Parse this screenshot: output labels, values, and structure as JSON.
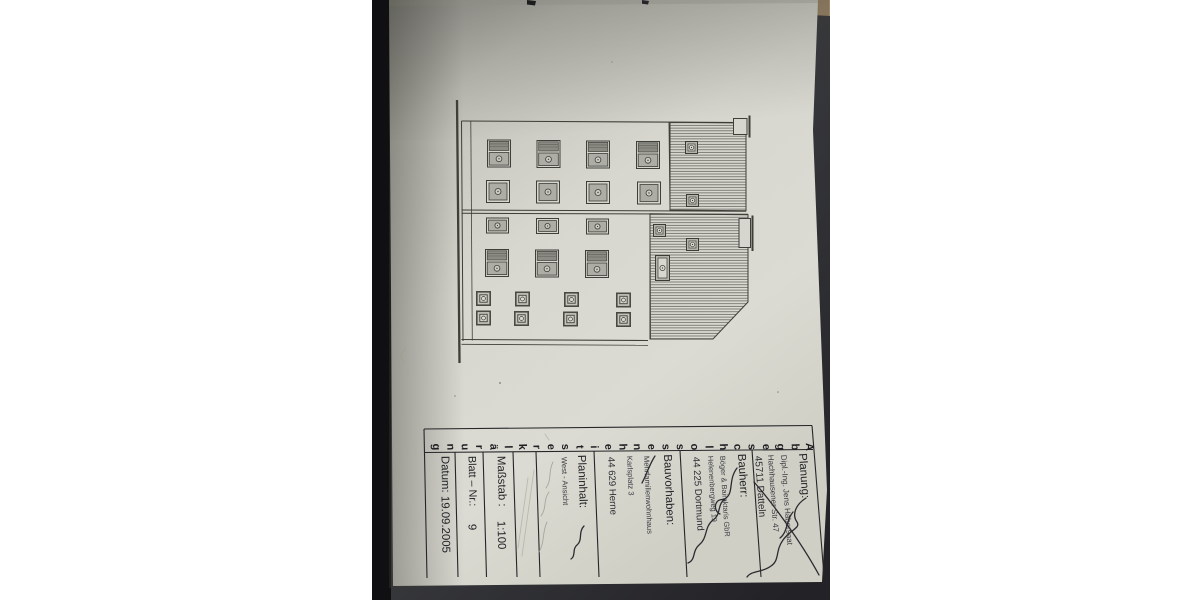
{
  "document": {
    "type_label_vertical": "Abgeschlossenheitserklärung",
    "title_block": {
      "planung": {
        "label": "Planung:",
        "line1": "Dipl.-Ing. Jens Habersaat",
        "line2": "Hachhausener Str. 47",
        "line3": "45711 Datteln"
      },
      "bauherr": {
        "label": "Bauherr:",
        "line1": "Böger & Bairaktaris GbR",
        "line2": "Helenenbergweg 19",
        "line3": "44 225 Dortmund"
      },
      "bauvorhaben": {
        "label": "Bauvorhaben:",
        "line1": "Mehrfamilienwohnhaus",
        "line2": "Karlsplatz 3",
        "line3": "44 629 Herne"
      },
      "planinhalt": {
        "label": "Planinhalt:",
        "line1": "West - Ansicht"
      },
      "massstab": {
        "label": "Maßstab :",
        "value": "1:100"
      },
      "blatt_nr": {
        "label": "Blatt – Nr.:",
        "value": "9"
      },
      "datum": {
        "label": "Datum:",
        "value": "19.09.2005"
      }
    },
    "colors": {
      "paper": "#d8d8d0",
      "ink": "#3f3f39",
      "background": "#3a3b3f"
    }
  }
}
